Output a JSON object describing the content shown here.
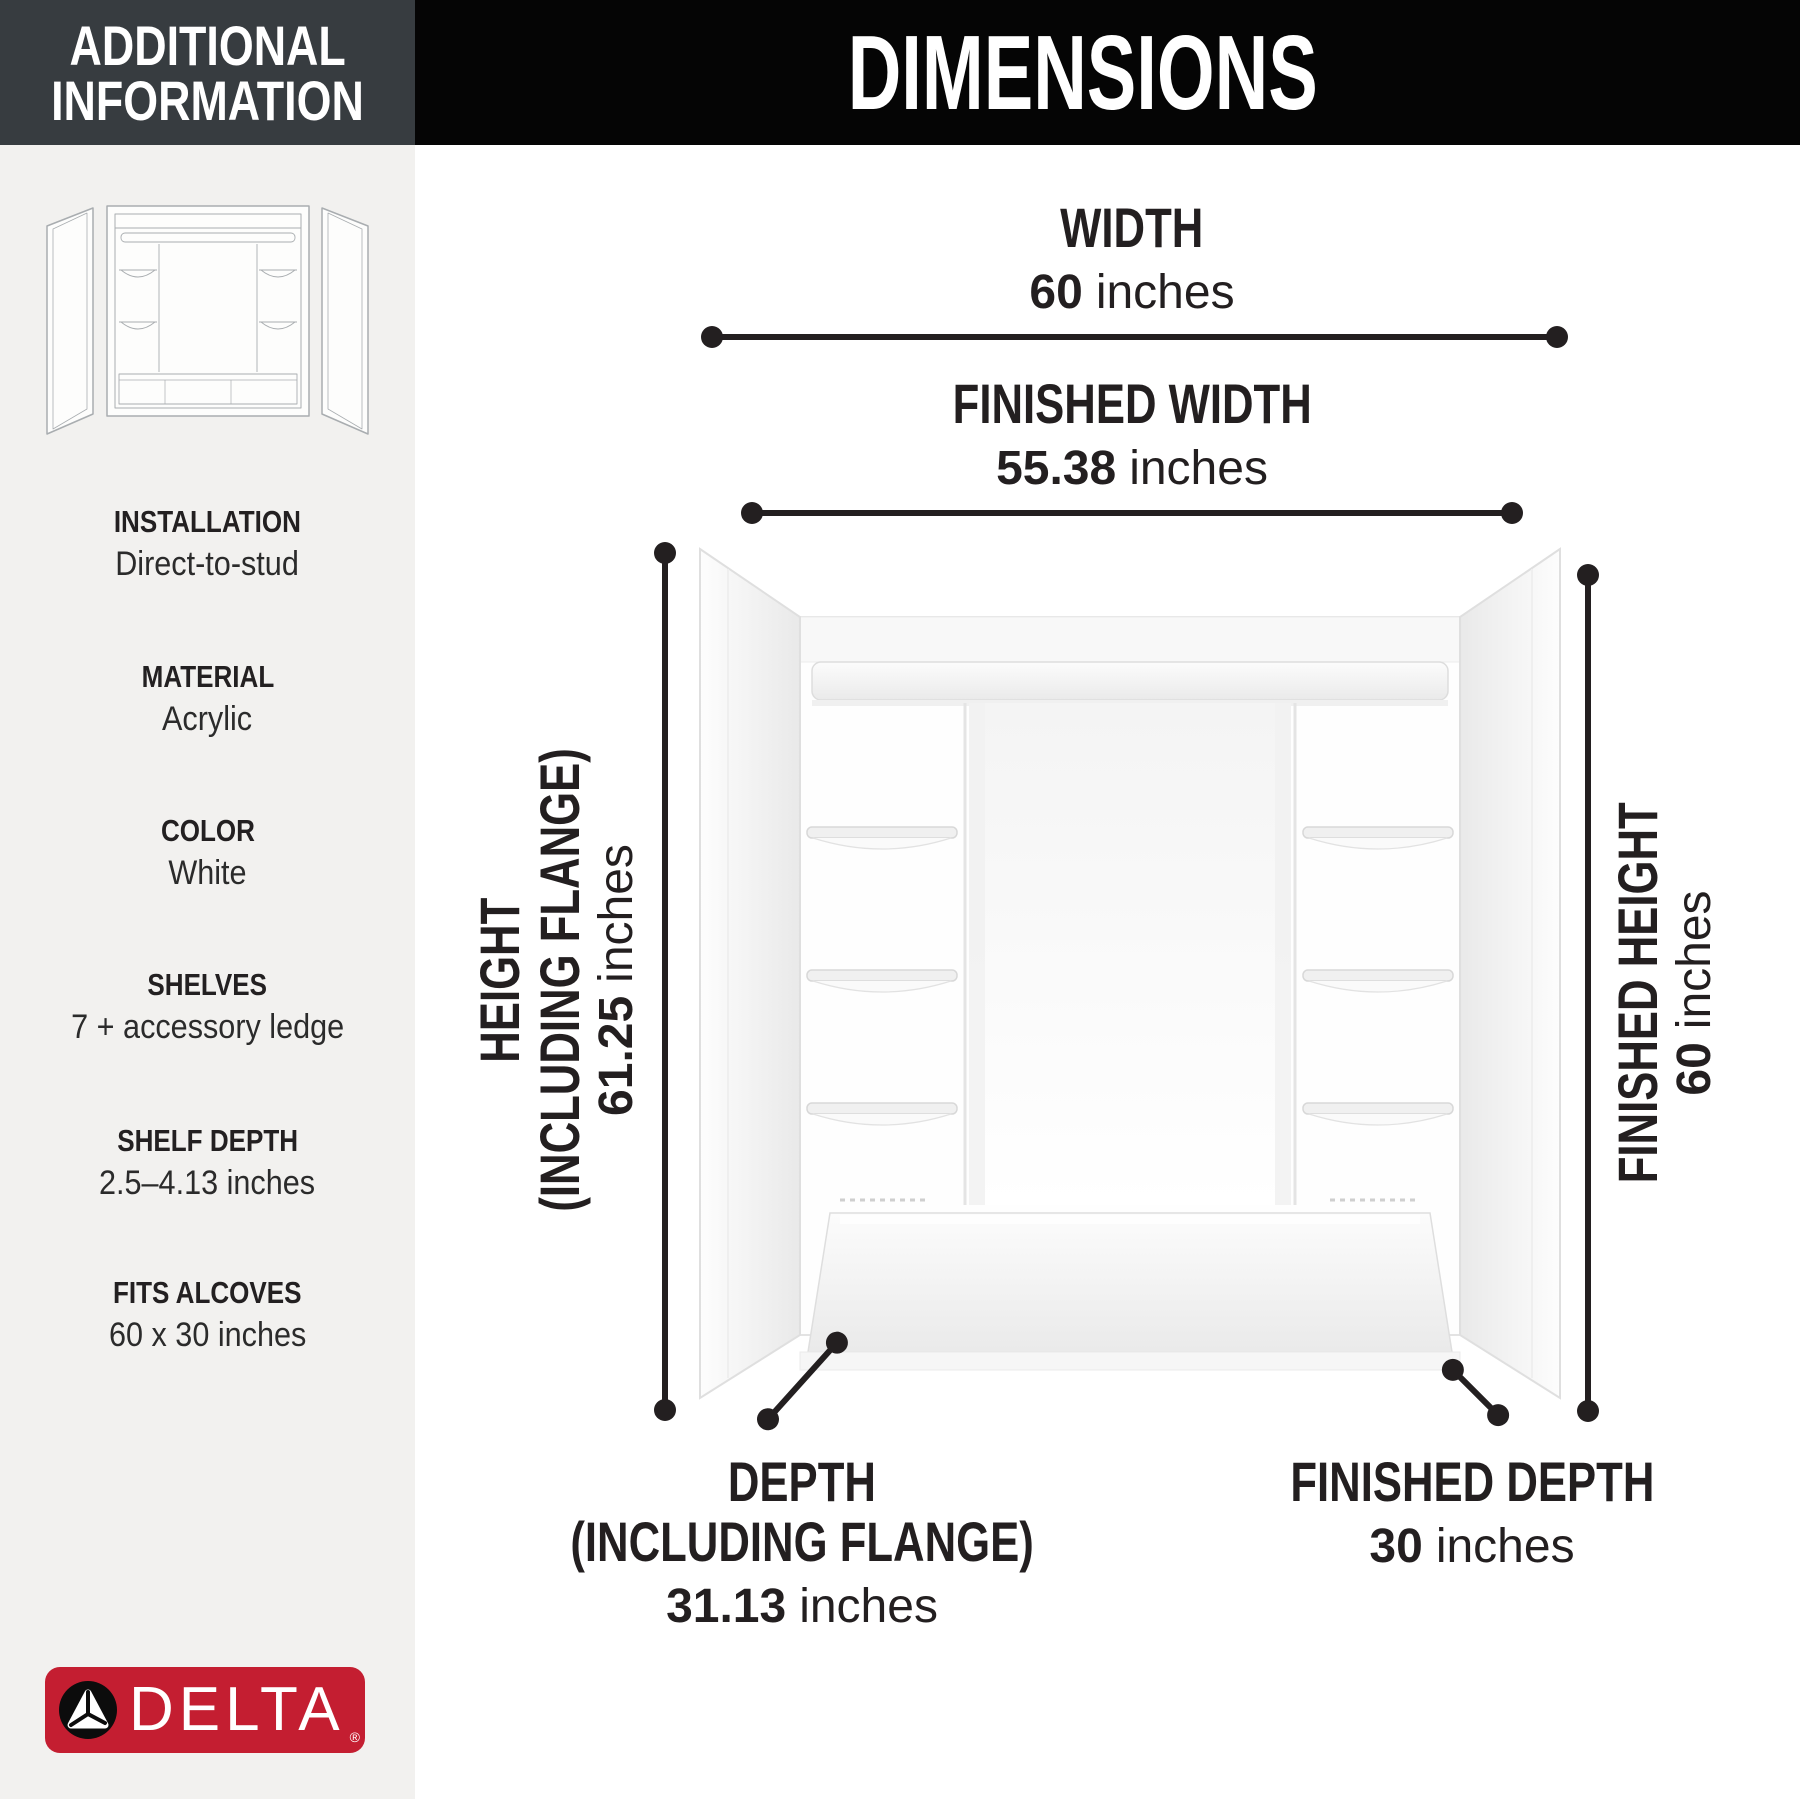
{
  "sidebar": {
    "header": {
      "line1": "ADDITIONAL",
      "line2": "INFORMATION"
    },
    "illustration_icon": "shower-wall-set-line-drawing",
    "specs": [
      {
        "label": "INSTALLATION",
        "value": "Direct-to-stud"
      },
      {
        "label": "MATERIAL",
        "value": "Acrylic"
      },
      {
        "label": "COLOR",
        "value": "White"
      },
      {
        "label": "SHELVES",
        "value": "7 + accessory ledge"
      },
      {
        "label": "SHELF DEPTH",
        "value": "2.5–4.13 inches"
      },
      {
        "label": "FITS ALCOVES",
        "value": "60 x 30 inches"
      }
    ],
    "logo": {
      "brand": "DELTA",
      "registered": "®",
      "glyph_icon": "delta-triangle-icon"
    }
  },
  "main": {
    "header": {
      "title": "DIMENSIONS"
    },
    "dims": {
      "width": {
        "label": "WIDTH",
        "value": "60",
        "unit": "inches"
      },
      "finished_width": {
        "label": "FINISHED WIDTH",
        "value": "55.38",
        "unit": "inches"
      },
      "height": {
        "label1": "HEIGHT",
        "label2": "(INCLUDING FLANGE)",
        "value": "61.25",
        "unit": "inches"
      },
      "finished_height": {
        "label": "FINISHED HEIGHT",
        "value": "60",
        "unit": "inches"
      },
      "depth": {
        "label1": "DEPTH",
        "label2": "(INCLUDING FLANGE)",
        "value": "31.13",
        "unit": "inches"
      },
      "finished_depth": {
        "label": "FINISHED DEPTH",
        "value": "30",
        "unit": "inches"
      }
    },
    "drawing_icon": "shower-wall-set-render"
  },
  "colors": {
    "ink": "#231f20",
    "header_black": "#050505",
    "sidebar_header_bg": "#373c40",
    "sidebar_bg": "#f2f1ef",
    "delta_red": "#c41e31",
    "drawing_outline": "#e3e3e3"
  }
}
